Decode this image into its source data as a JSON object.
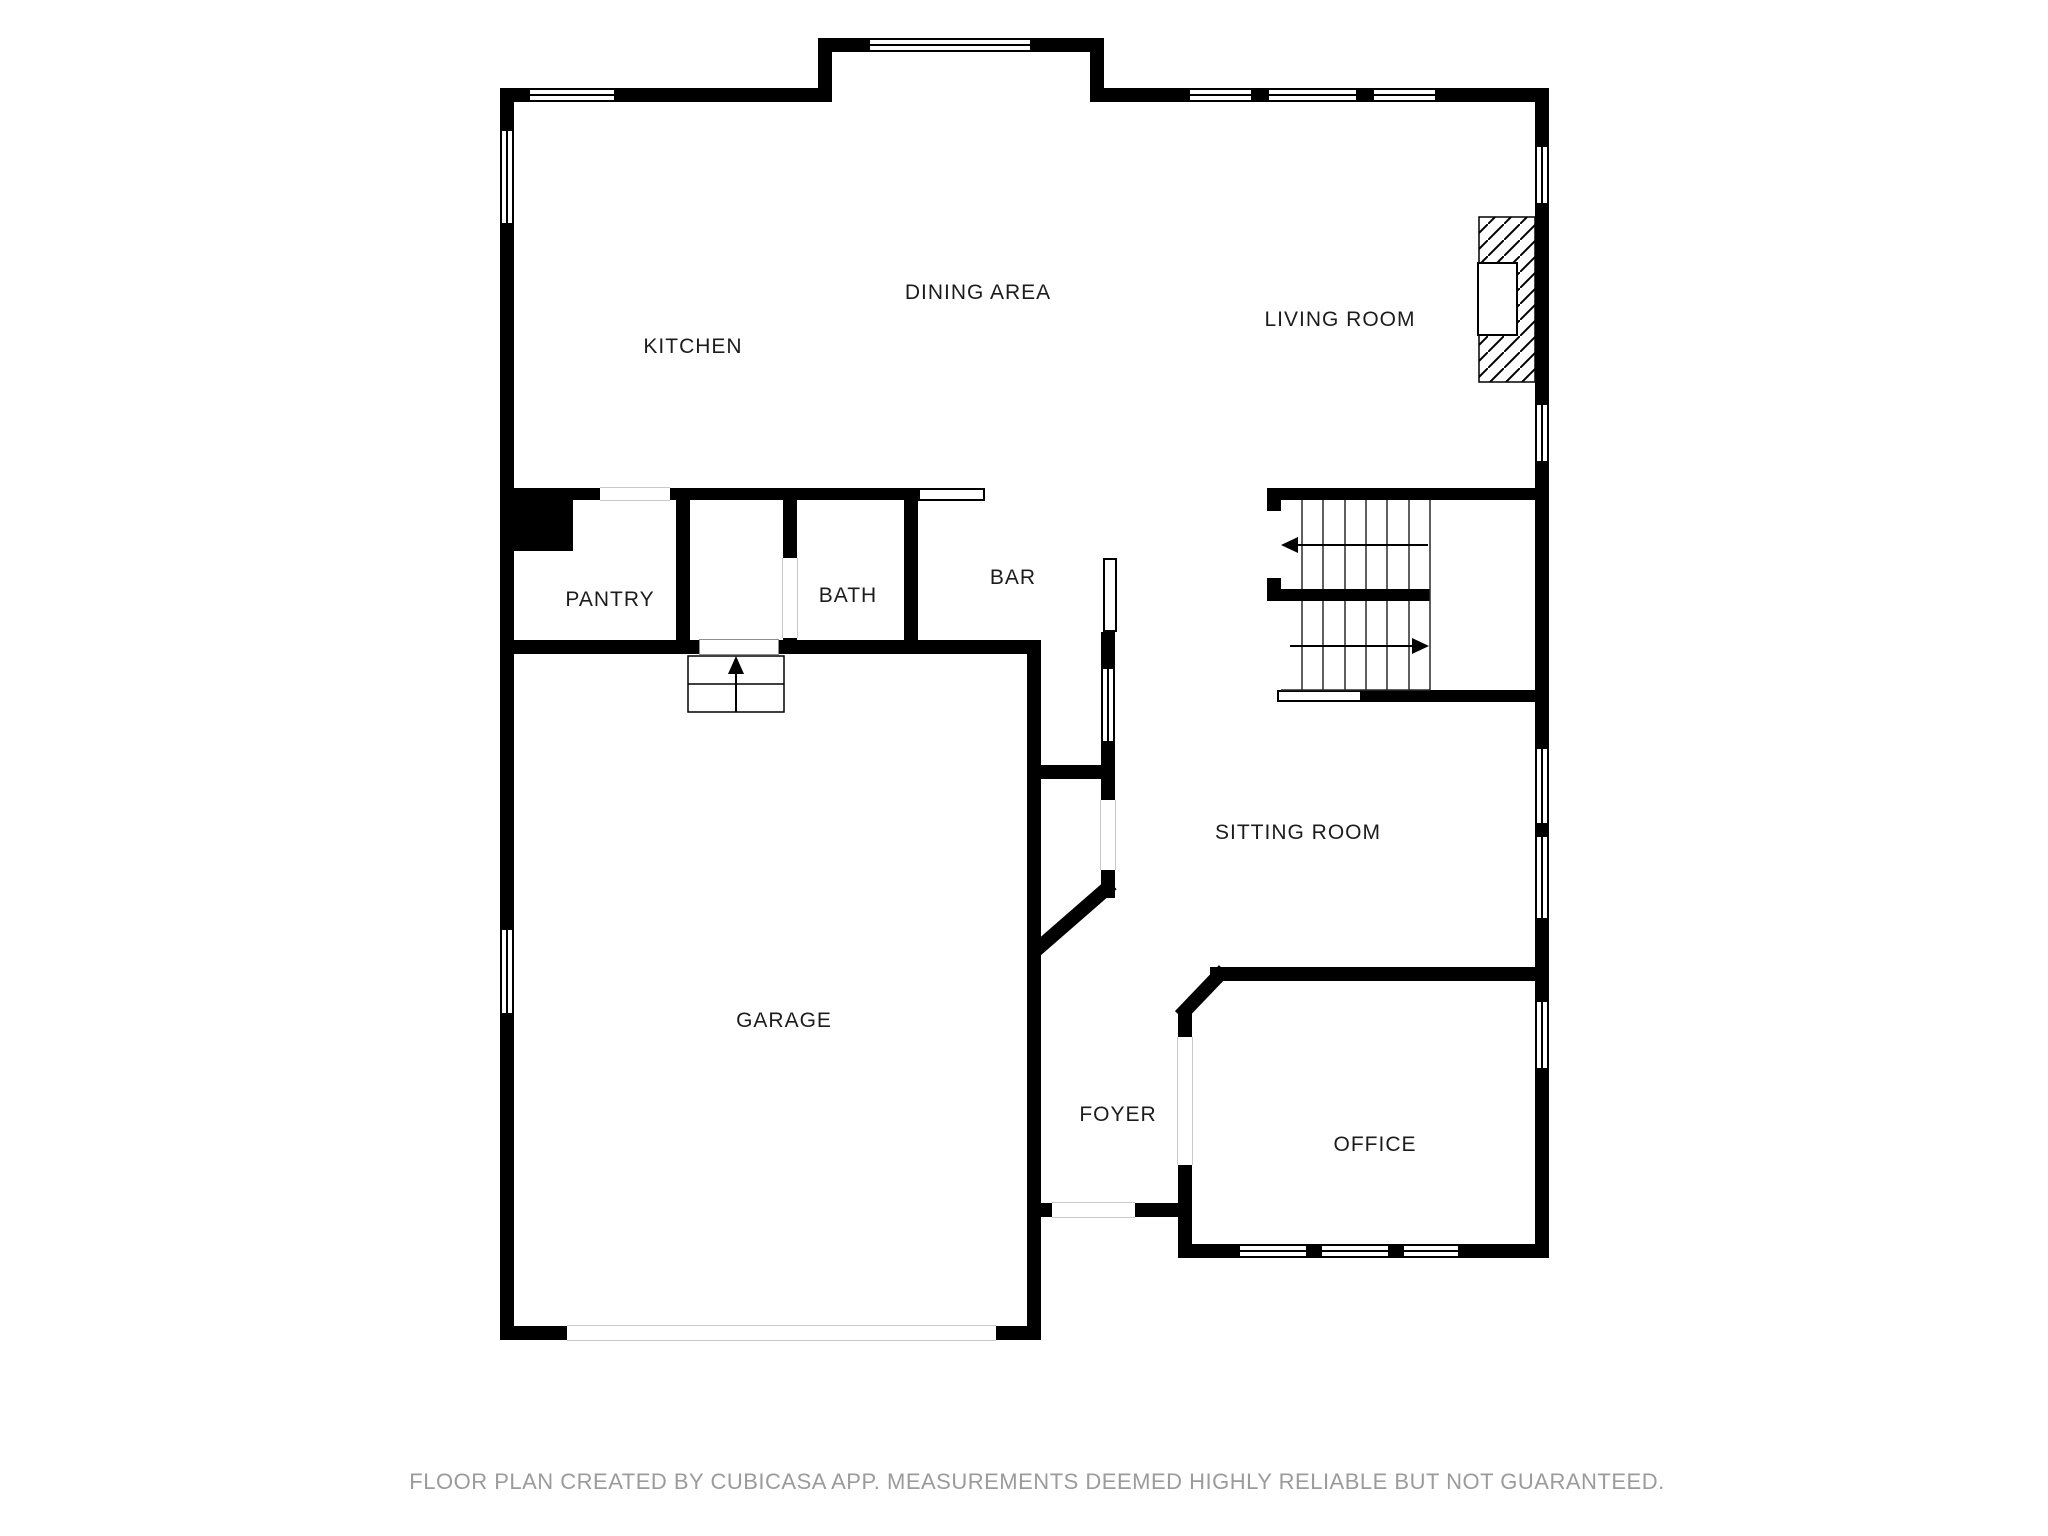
{
  "rooms": {
    "kitchen": {
      "label": "KITCHEN"
    },
    "dining_area": {
      "label": "DINING AREA"
    },
    "living_room": {
      "label": "LIVING ROOM"
    },
    "pantry": {
      "label": "PANTRY"
    },
    "bath": {
      "label": "BATH"
    },
    "bar": {
      "label": "BAR"
    },
    "sitting_room": {
      "label": "SITTING ROOM"
    },
    "garage": {
      "label": "GARAGE"
    },
    "foyer": {
      "label": "FOYER"
    },
    "office": {
      "label": "OFFICE"
    }
  },
  "footer": {
    "disclaimer": "FLOOR PLAN CREATED BY CUBICASA APP. MEASUREMENTS DEEMED HIGHLY RELIABLE BUT NOT GUARANTEED."
  },
  "icons": {
    "upper_flight_arrow": "arrow-left-icon",
    "lower_flight_arrow": "arrow-right-icon",
    "garage_steps_arrow": "arrow-up-icon"
  },
  "colors": {
    "walls": "#000000",
    "room_labels": "#1c1c1c",
    "disclaimer_text": "#9b9b9b",
    "background": "#ffffff",
    "door_threshold": "#c9c9c9"
  }
}
